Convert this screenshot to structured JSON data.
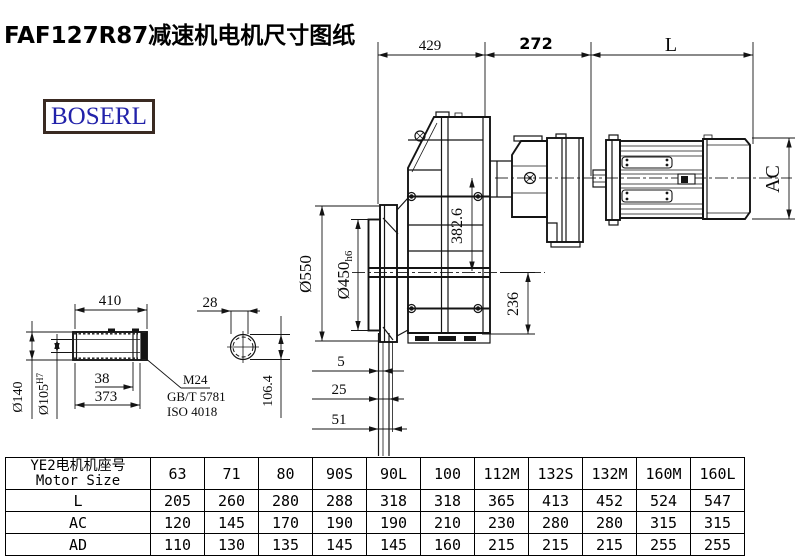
{
  "title": "FAF127R87减速机电机尺寸图纸",
  "logo": {
    "text": "BOSERL"
  },
  "colors": {
    "logo_text": "#2222aa",
    "logo_border": "#3a2a22",
    "line": "#141414"
  },
  "drawing": {
    "dim_labels": {
      "top_left": "429",
      "top_mid": "272",
      "top_right": "L",
      "motor_height": "AC",
      "flange_od": "Ø550",
      "flange_spigot": "Ø450",
      "flange_spigot_tol": "h6",
      "center_height": "382.6",
      "base_height": "236",
      "offset_1": "5",
      "offset_2": "25",
      "offset_3": "51",
      "shaft_len": "410",
      "shaft_d1": "38",
      "shaft_d2": "373",
      "shaft_od": "Ø140",
      "shaft_bore": "Ø105",
      "shaft_bore_tol": "H7",
      "keyway": "28",
      "end_height": "106.4",
      "thread": "M24",
      "std1": "GB/T 5781",
      "std2": "ISO 4018"
    }
  },
  "table": {
    "header_cn": "YE2电机机座号",
    "header_en": "Motor Size",
    "sizes": [
      "63",
      "71",
      "80",
      "90S",
      "90L",
      "100",
      "112M",
      "132S",
      "132M",
      "160M",
      "160L"
    ],
    "rows": [
      {
        "label": "L",
        "values": [
          "205",
          "260",
          "280",
          "288",
          "318",
          "318",
          "365",
          "413",
          "452",
          "524",
          "547"
        ]
      },
      {
        "label": "AC",
        "values": [
          "120",
          "145",
          "170",
          "190",
          "190",
          "210",
          "230",
          "280",
          "280",
          "315",
          "315"
        ]
      },
      {
        "label": "AD",
        "values": [
          "110",
          "130",
          "135",
          "145",
          "145",
          "160",
          "215",
          "215",
          "215",
          "255",
          "255"
        ]
      }
    ]
  }
}
